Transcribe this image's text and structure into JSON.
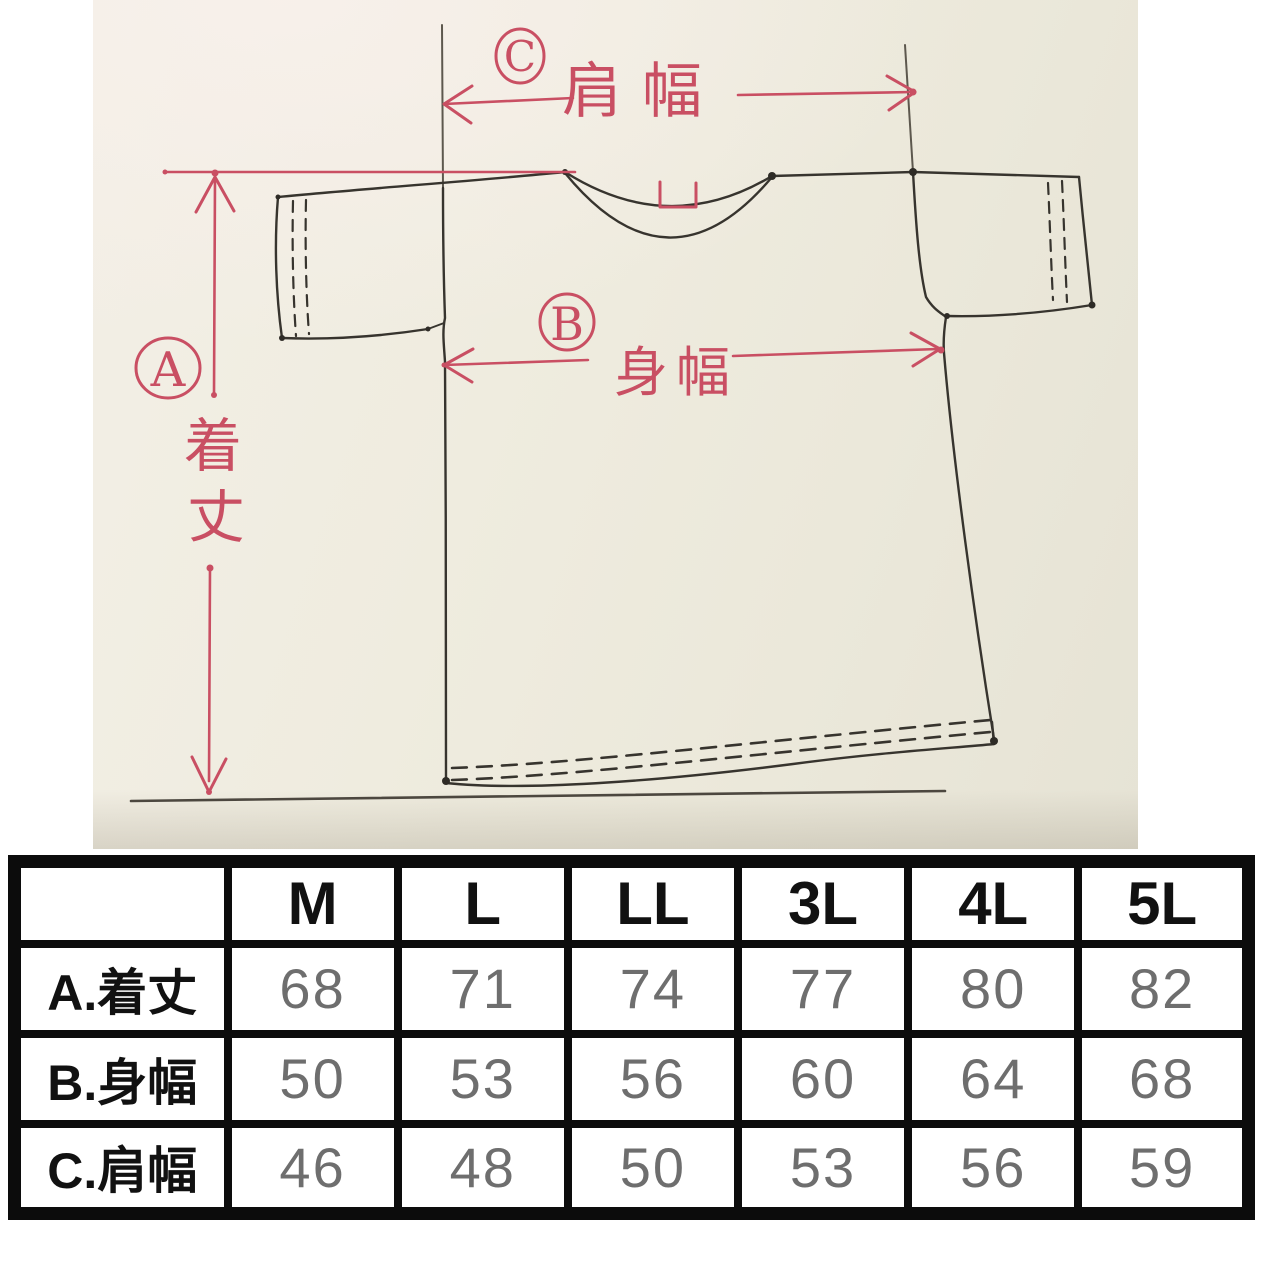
{
  "photo": {
    "annotations": {
      "label_a": "A",
      "label_b": "B",
      "label_c": "C",
      "length_char_top": "着",
      "length_char_bottom": "丈",
      "shoulder_width": "肩幅",
      "body_width": "身幅"
    },
    "colors": {
      "ink": "#37342e",
      "red_ink": "#c94f63",
      "paper": "#eeebdd"
    }
  },
  "size_table": {
    "header": [
      "",
      "M",
      "L",
      "LL",
      "3L",
      "4L",
      "5L"
    ],
    "rows": [
      {
        "label": "A.着丈",
        "values": [
          "68",
          "71",
          "74",
          "77",
          "80",
          "82"
        ]
      },
      {
        "label": "B.身幅",
        "values": [
          "50",
          "53",
          "56",
          "60",
          "64",
          "68"
        ]
      },
      {
        "label": "C.肩幅",
        "values": [
          "46",
          "48",
          "50",
          "53",
          "56",
          "59"
        ]
      }
    ]
  }
}
